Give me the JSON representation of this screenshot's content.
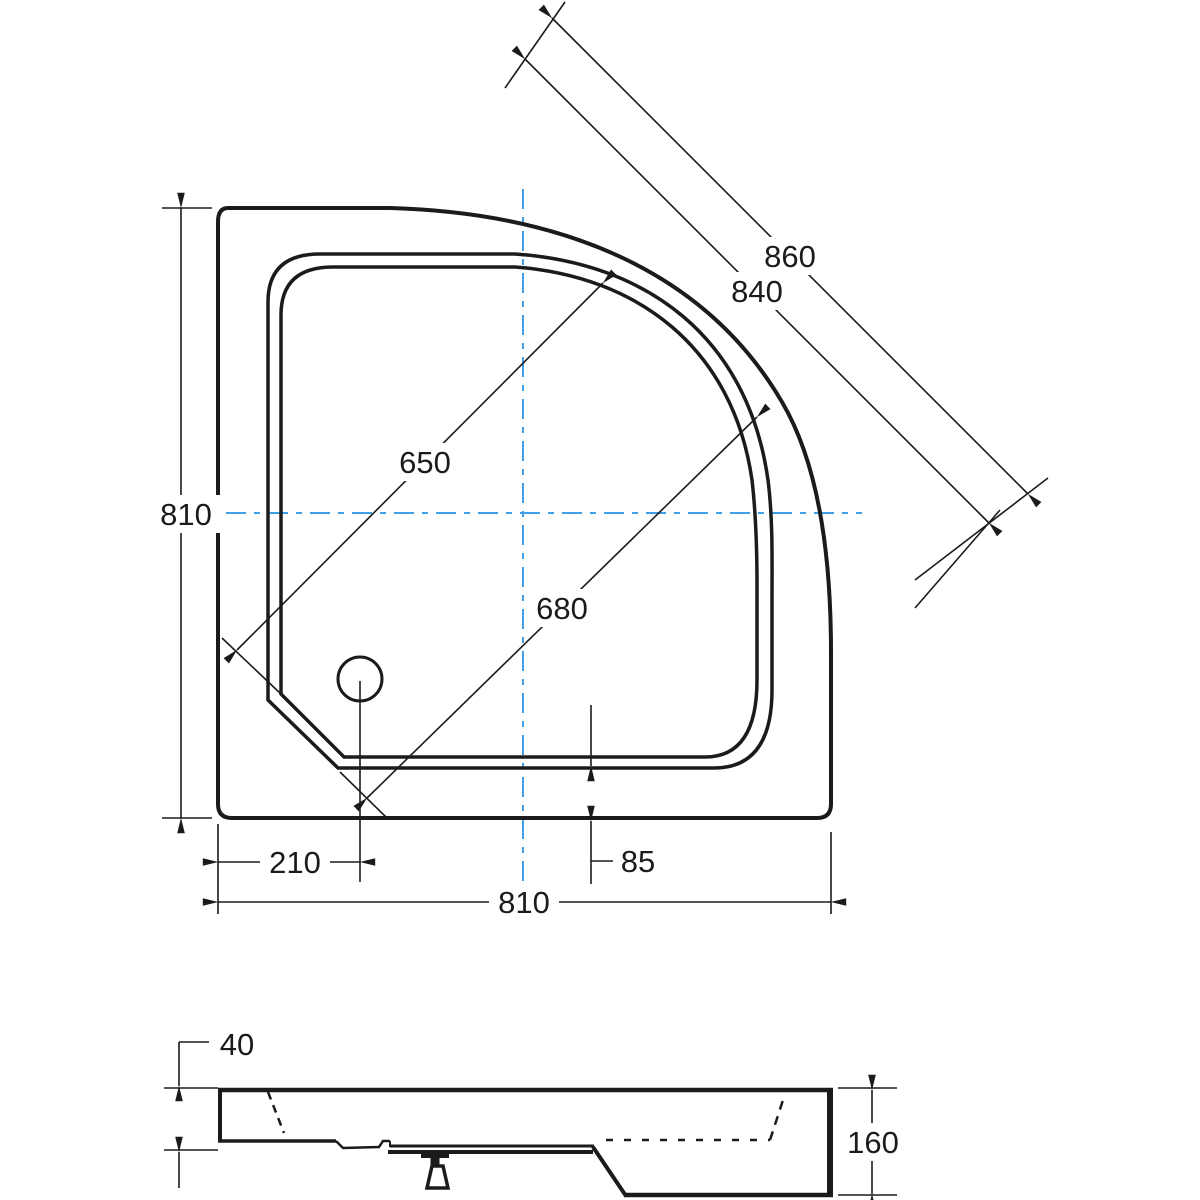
{
  "colors": {
    "line": "#1b1b1b",
    "centerline": "#3fa0e8",
    "background": "#ffffff"
  },
  "dims": {
    "left_height": "810",
    "bottom_width": "810",
    "outer_diagonal": "860",
    "rim_diagonal": "840",
    "basin_diagonal": "650",
    "tray_diagonal": "680",
    "drain_offset": "210",
    "bottom_rim_width": "85",
    "rim_edge_height": "40",
    "total_height": "160"
  }
}
